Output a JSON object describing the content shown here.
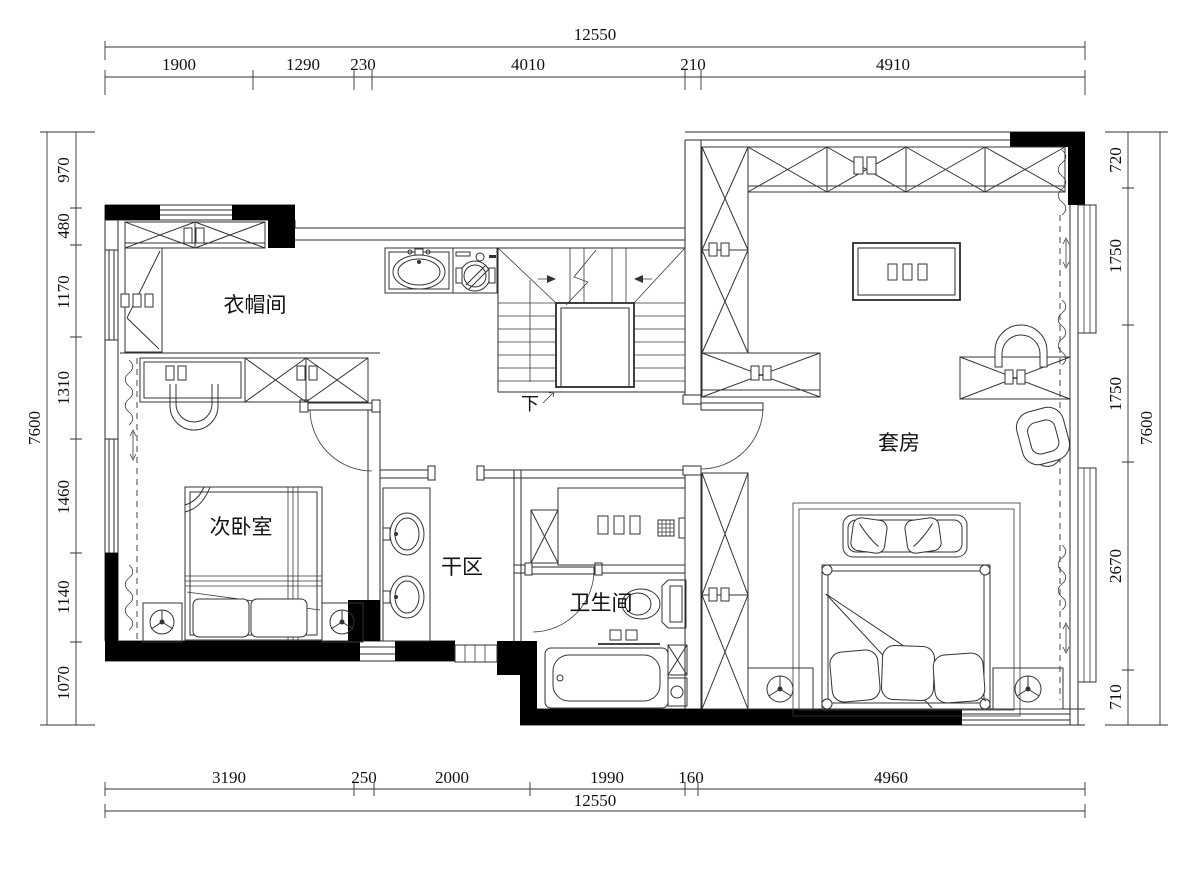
{
  "page": {
    "background": "#ffffff",
    "line_color": "#2b2b2b",
    "wall_fill": "#000000"
  },
  "rooms": {
    "cloakroom": {
      "label": "衣帽间"
    },
    "second_bedroom": {
      "label": "次卧室"
    },
    "dry_area": {
      "label": "干区"
    },
    "bathroom": {
      "label": "卫生间"
    },
    "suite": {
      "label": "套房"
    },
    "stairs": {
      "down_label": "下"
    }
  },
  "dimensions": {
    "top": {
      "total": "12550",
      "segments": [
        "1900",
        "1290",
        "230",
        "4010",
        "210",
        "4910"
      ]
    },
    "bottom": {
      "total": "12550",
      "segments": [
        "3190",
        "250",
        "2000",
        "1990",
        "160",
        "4960"
      ]
    },
    "left": {
      "total": "7600",
      "segments": [
        "970",
        "480",
        "1170",
        "1310",
        "1460",
        "1140",
        "1070"
      ]
    },
    "right": {
      "total": "7600",
      "segments": [
        "720",
        "1750",
        "1750",
        "2670",
        "710"
      ]
    }
  }
}
